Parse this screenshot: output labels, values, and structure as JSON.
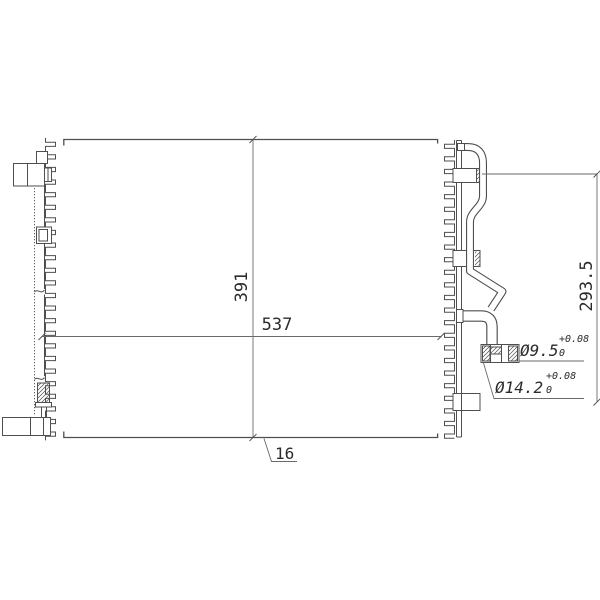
{
  "drawing": {
    "kind": "condenser-engineering-drawing",
    "background": "#ffffff",
    "line_color": "#4f4f4f",
    "dim_line_color": "#6a6a6a",
    "text_color": "#2b2b2b"
  },
  "labels": {
    "core_height": "391",
    "core_width": "537",
    "pipe_span": "293.5",
    "core_thickness": "16",
    "port_inner_dia": "Ø9.5",
    "port_inner_tol_upper": "+0.08",
    "port_inner_tol_lower": "0",
    "port_outer_dia": "Ø14.2",
    "port_outer_tol_upper": "+0.08",
    "port_outer_tol_lower": "0"
  }
}
